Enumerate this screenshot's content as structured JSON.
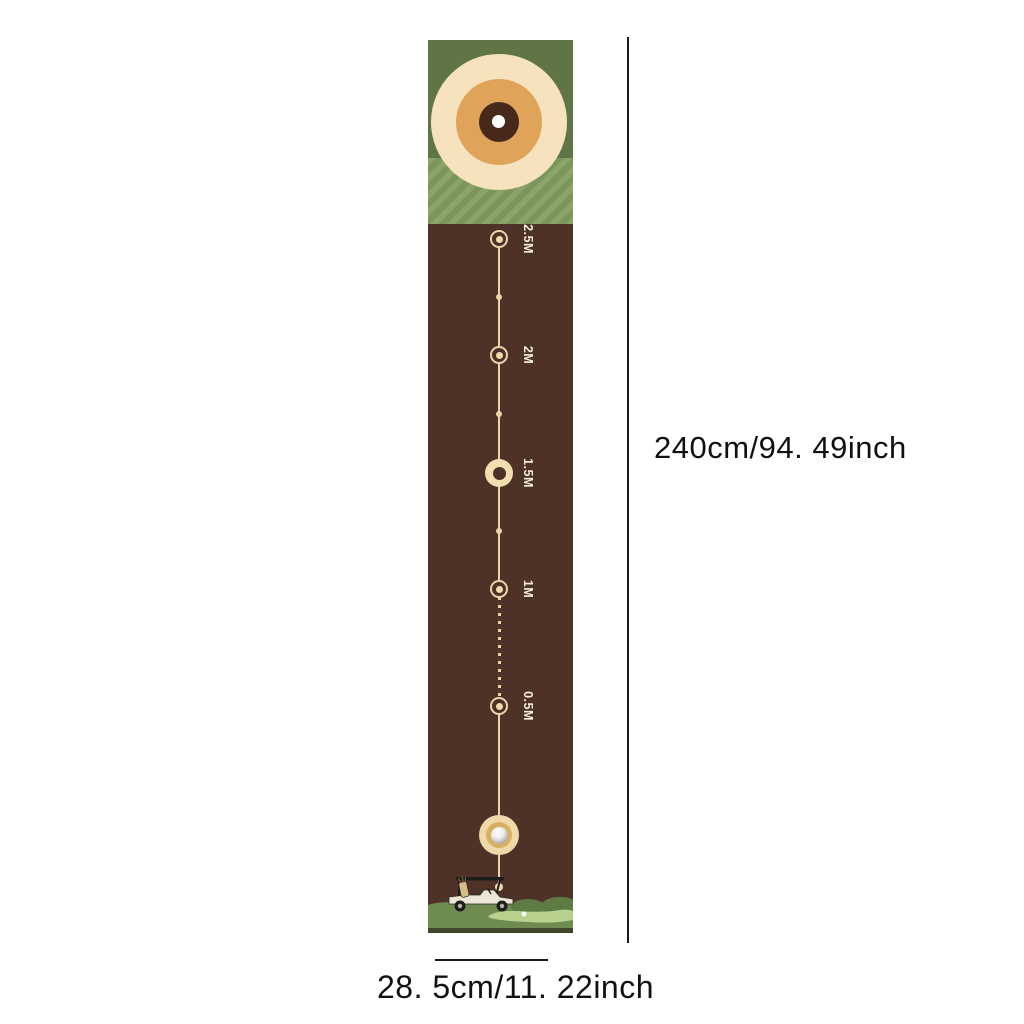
{
  "product": {
    "name": "golf-putting-mat-dimension-diagram",
    "mat": {
      "markers": [
        {
          "label": "2.5M"
        },
        {
          "label": "2M"
        },
        {
          "label": "1.5M"
        },
        {
          "label": "1M"
        },
        {
          "label": "0.5M"
        }
      ],
      "icons": [
        "bullseye-target-icon",
        "golf-ball-icon",
        "golf-cart-icon",
        "putting-green-icon"
      ]
    },
    "dimensions": {
      "height_label": "240cm/94. 49inch",
      "width_label": "28. 5cm/11. 22inch"
    },
    "colors": {
      "mat_brown": "#4E3228",
      "header_green": "#5F7546",
      "stripe_light": "#8CA368",
      "stripe_dark": "#7C955B",
      "target_cream": "#F6E2BC",
      "target_orange": "#DFA45A",
      "target_dark_brown": "#47291B",
      "line_cream": "#E8D5A9",
      "label_text": "#F3EDDE",
      "green_base": "#6F8C50",
      "green_mound": "#5E7B44",
      "green_light": "#B9D18F",
      "bottom_strip": "#3D4629",
      "dimension_text": "#111111"
    }
  }
}
